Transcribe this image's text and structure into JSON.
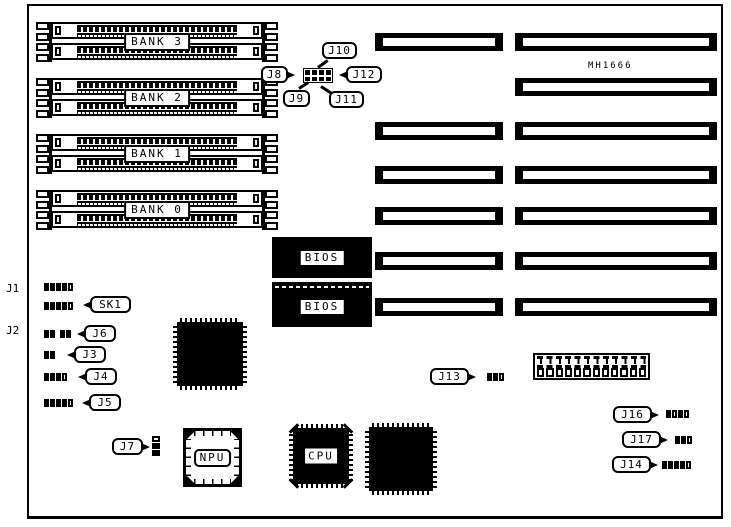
{
  "diagram": {
    "model_label": "MH1666",
    "edge_labels": {
      "j1": "J1",
      "j2": "J2"
    },
    "banks": [
      {
        "label": "BANK 3"
      },
      {
        "label": "BANK 2"
      },
      {
        "label": "BANK 1"
      },
      {
        "label": "BANK 0"
      }
    ],
    "bios_chips": [
      {
        "label": "BIOS"
      },
      {
        "label": "BIOS"
      }
    ],
    "chip_labels": {
      "npu": "NPU",
      "cpu": "CPU"
    },
    "callouts": {
      "j8": "J8",
      "j9": "J9",
      "j10": "J10",
      "j11": "J11",
      "j12": "J12",
      "sk1": "SK1",
      "j6": "J6",
      "j3": "J3",
      "j4": "J4",
      "j5": "J5",
      "j7": "J7",
      "j13": "J13",
      "j16": "J16",
      "j17": "J17",
      "j14": "J14"
    },
    "pins": {
      "j1": "ffffo",
      "sk1": "ffffo",
      "j6a": "ff",
      "j6b": "ff",
      "j3": "ff",
      "j4": "fffo",
      "j5": "ffffo",
      "j7": "off",
      "j13": "ffo",
      "j16": "fofo",
      "j17": "ffo",
      "j14": "ffffo"
    },
    "jumper_block": {
      "rows": 2,
      "cols": 4
    },
    "power_connector": {
      "pin_count": 12
    },
    "colors": {
      "ink": "#000000",
      "paper": "#ffffff"
    }
  }
}
